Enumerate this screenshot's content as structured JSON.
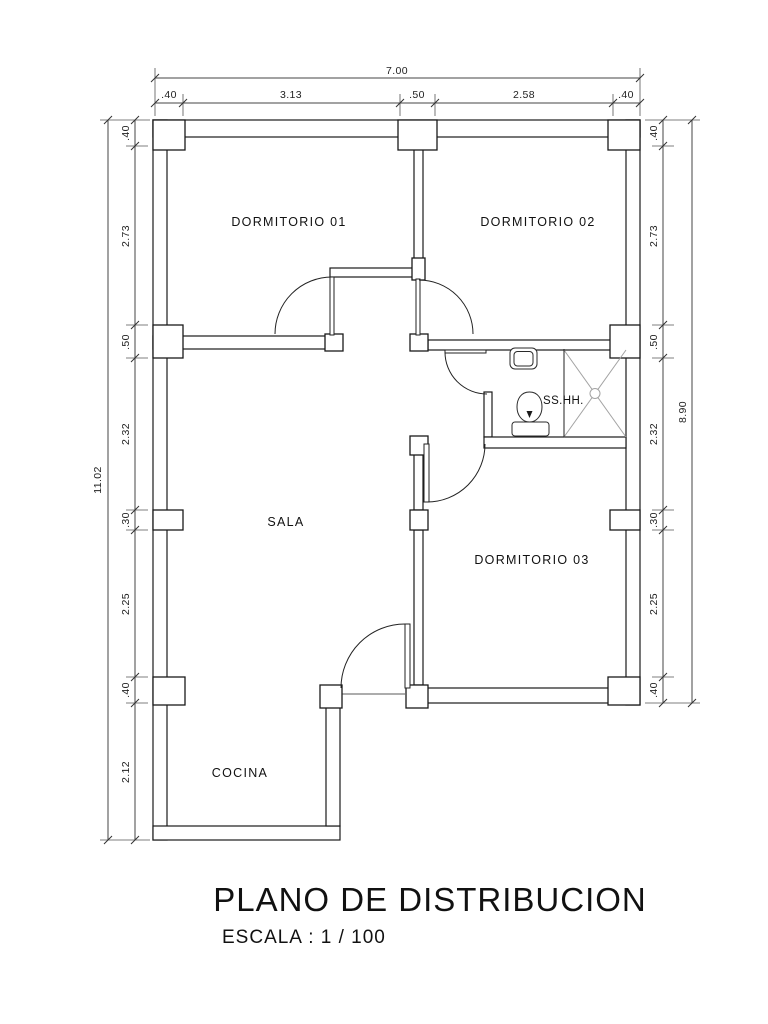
{
  "title": {
    "main": "PLANO DE DISTRIBUCION",
    "scale": "ESCALA :  1 / 100"
  },
  "rooms": {
    "dormitorio_01": "DORMITORIO 01",
    "dormitorio_02": "DORMITORIO 02",
    "sala": "SALA",
    "dormitorio_03": "DORMITORIO 03",
    "cocina": "COCINA",
    "bathroom": "SS.HH."
  },
  "dimensions": {
    "top": {
      "overall": "7.00",
      "segments": [
        ".40",
        "3.13",
        ".50",
        "2.58",
        ".40"
      ]
    },
    "left": {
      "overall": "11.02",
      "segments": [
        ".40",
        "2.73",
        ".50",
        "2.32",
        ".30",
        "2.25",
        ".40",
        "2.12"
      ]
    },
    "right": {
      "overall": "8.90",
      "segments": [
        ".40",
        "2.73",
        ".50",
        "2.32",
        ".30",
        "2.25",
        ".40"
      ]
    }
  },
  "colors": {
    "background": "#ffffff",
    "wall_line": "#1a1a1a",
    "dimension_line": "#444444",
    "shower_cross": "#a3a3a3",
    "text": "#111111"
  }
}
